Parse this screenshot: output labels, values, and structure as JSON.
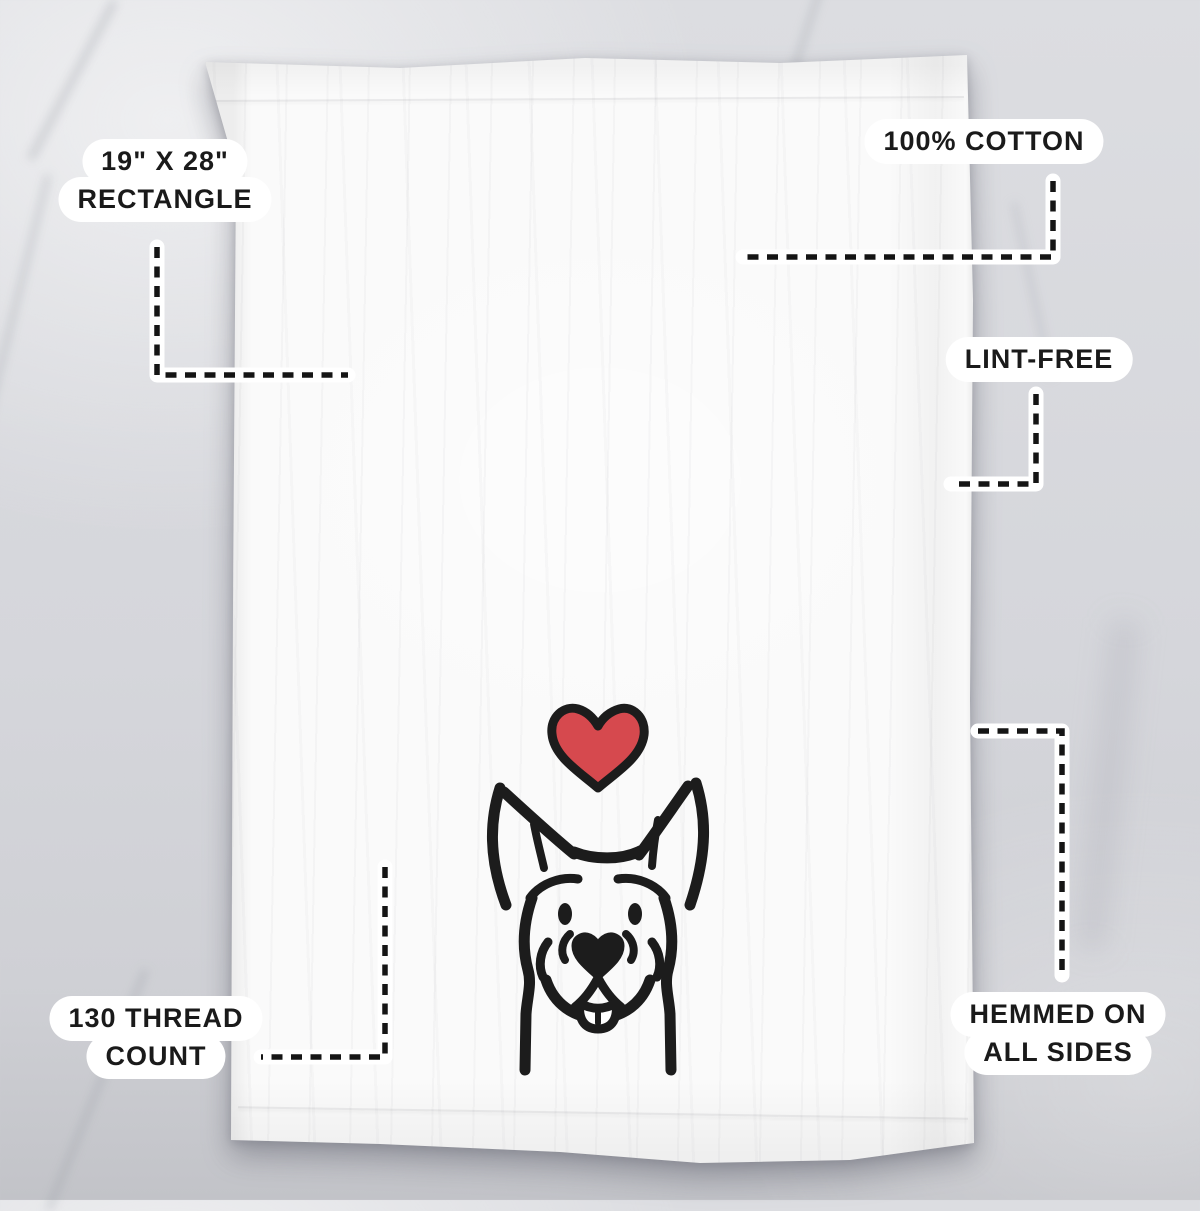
{
  "callouts": {
    "size": {
      "line1": "19\" X 28\"",
      "line2": "RECTANGLE"
    },
    "cotton": {
      "line1": "100% COTTON"
    },
    "lint": {
      "line1": "LINT-FREE"
    },
    "thread": {
      "line1": "130 THREAD",
      "line2": "COUNT"
    },
    "hem": {
      "line1": "HEMMED ON",
      "line2": "ALL SIDES"
    }
  },
  "colors": {
    "heart_red": "#d6494e",
    "ink": "#1c1c1c",
    "label_bg": "#ffffff",
    "dash_black": "#151515",
    "towel_white": "#fafafa"
  }
}
